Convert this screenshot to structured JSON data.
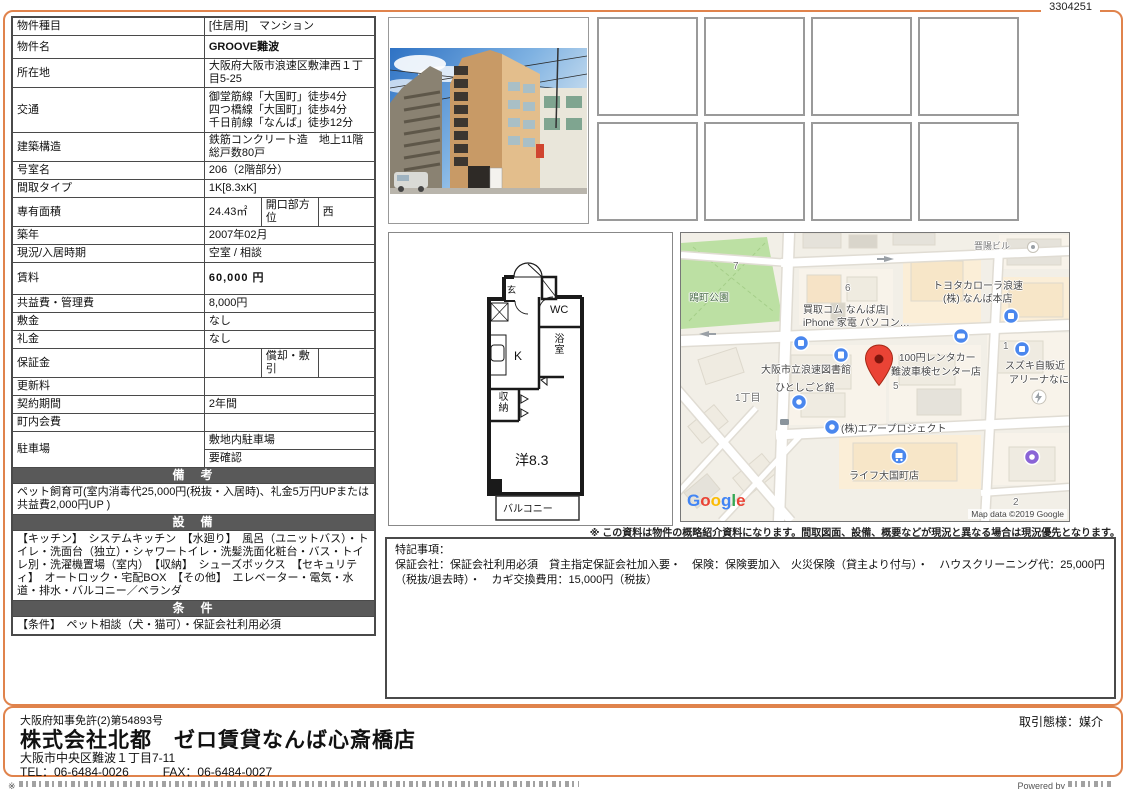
{
  "doc_number": "3304251",
  "colors": {
    "accent_orange": "#E0834C",
    "section_header_gray": "#595959",
    "map_pin_red": "#EA4335"
  },
  "property": {
    "rows": {
      "type": {
        "label": "物件種目",
        "value": "[住居用]　マンション"
      },
      "name": {
        "label": "物件名",
        "value": "GROOVE難波"
      },
      "address": {
        "label": "所在地",
        "value": "大阪府大阪市浪速区敷津西１丁目5-25"
      },
      "access": {
        "label": "交通",
        "lines": [
          "御堂筋線「大国町」徒歩4分",
          "四つ橋線「大国町」徒歩4分",
          "千日前線「なんば」徒歩12分"
        ]
      },
      "structure": {
        "label": "建築構造",
        "value": "鉄筋コンクリート造　地上11階　総戸数80戸"
      },
      "room_no": {
        "label": "号室名",
        "value": "206（2階部分）"
      },
      "layout_type": {
        "label": "間取タイプ",
        "value": "1K[8.3xK]"
      },
      "area": {
        "label": "専有面積",
        "value": "24.43㎡",
        "label2": "開口部方位",
        "value2": "西"
      },
      "built": {
        "label": "築年",
        "value": "2007年02月"
      },
      "status": {
        "label": "現況/入居時期",
        "value": "空室 / 相談"
      },
      "rent": {
        "label": "賃料",
        "value": "60,000 円"
      },
      "fees": {
        "label": "共益費・管理費",
        "value": "8,000円"
      },
      "deposit": {
        "label": "敷金",
        "value": "なし"
      },
      "key_money": {
        "label": "礼金",
        "value": "なし"
      },
      "guarantee": {
        "label": "保証金",
        "value": "",
        "label2": "償却・敷引",
        "value2": ""
      },
      "renewal": {
        "label": "更新料",
        "value": ""
      },
      "term": {
        "label": "契約期間",
        "value": "2年間"
      },
      "neighborhood": {
        "label": "町内会費",
        "value": ""
      },
      "parking": {
        "label": "駐車場",
        "line1": "敷地内駐車場",
        "line2": "要確認"
      }
    },
    "sections": {
      "remarks": {
        "title": "備　考",
        "body": "ペット飼育可(室内消毒代25,000円(税抜・入居時)、礼金5万円UPまたは共益費2,000円UP )"
      },
      "equipment": {
        "title": "設　備",
        "body": "【キッチン】　システムキッチン　【水廻り】　風呂（ユニットバス）・トイレ・洗面台（独立）・シャワートイレ・洗髪洗面化粧台・バス・トイレ別・洗濯機置場（室内）　【収納】　シューズボックス　【セキュリティ】　オートロック・宅配BOX　【その他】　エレベーター・電気・水道・排水・バルコニー／ベランダ"
      },
      "conditions": {
        "title": "条　件",
        "body": "【条件】　ペット相談（犬・猫可）・保証会社利用必須"
      }
    }
  },
  "floorplan": {
    "labels": {
      "entrance": "玄",
      "wc": "WC",
      "kitchen": "K",
      "bath": "浴室",
      "closet": "収納",
      "room": "洋8.3",
      "balcony": "バルコニー"
    }
  },
  "map": {
    "places": {
      "park_no": "7",
      "park": "鴎町公園",
      "kaitori1": "買取コム なんば店|",
      "kaitori2": "iPhone 家電 パソコン…",
      "toyota1": "トヨタカローラ浪速",
      "toyota2": "(株) なんば本店",
      "bldg": "晋陽ビル",
      "block6": "6",
      "library1": "大阪市立浪速図書館",
      "library2": "ひとしごと館",
      "rental1": "100円レンタカー",
      "rental2": "難波車検センター店",
      "suzuki1": "スズキ自販近",
      "suzuki2": "アリーナなに",
      "chome": "1丁目",
      "air": "(株)エアープロジェクト",
      "life": "ライフ大国町店",
      "block5": "5",
      "block1": "1",
      "block2": "2"
    },
    "google_logo": {
      "g1": "G",
      "o1": "o",
      "o2": "o",
      "g2": "g",
      "l1": "l",
      "e1": "e"
    },
    "attribution": "Map data ©2019 Google",
    "note": "※ この資料は物件の概略紹介資料になります。間取図面、設備、概要などが現況と異なる場合は現況優先となります。"
  },
  "special_notes": {
    "title": "特記事項：",
    "body": "保証会社：保証会社利用必須　貸主指定保証会社加入要・　保険：保険要加入　火災保険（貸主より付与）・　ハウスクリーニング代：25,000円（税抜/退去時）・　カギ交換費用：15,000円（税抜）"
  },
  "footer": {
    "license": "大阪府知事免許(2)第54893号",
    "company": "株式会社北都　ゼロ賃貸なんば心斎橋店",
    "address": "大阪市中央区難波１丁目7-11",
    "tel": "TEL：06-6484-0026",
    "fax": "FAX：06-6484-0027",
    "deal_type": "取引態様：媒介"
  },
  "bottom_strip": {
    "left": "※",
    "right": "Powered by"
  }
}
